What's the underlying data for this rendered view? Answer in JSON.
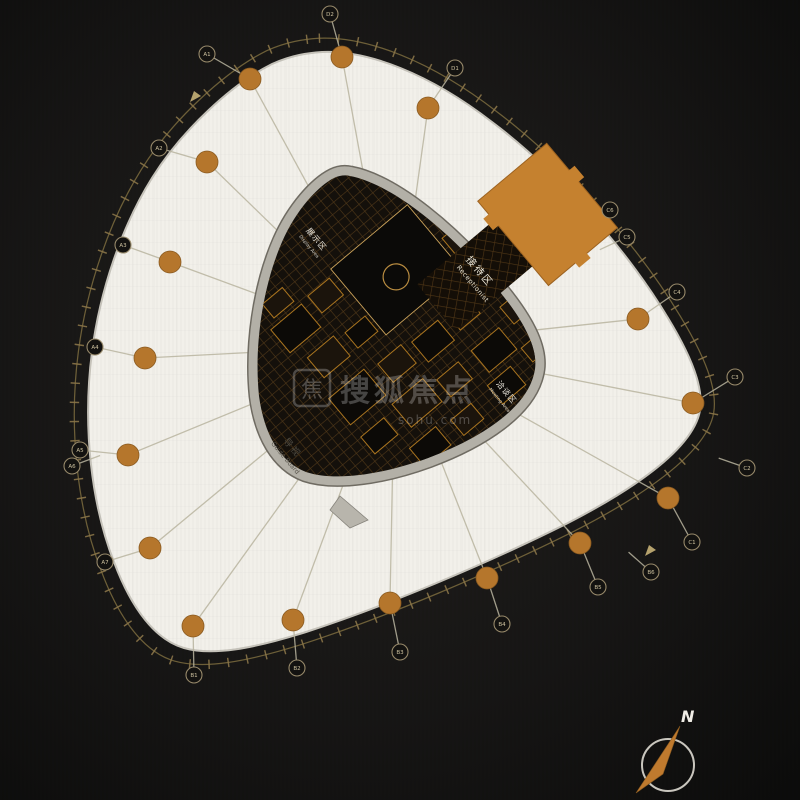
{
  "floor_plan": {
    "watermark": {
      "logo_char": "焦",
      "title": "搜狐焦点",
      "subtitle": "sohu.com"
    },
    "north": {
      "label": "N"
    },
    "zones": {
      "reception": {
        "zh": "接待区",
        "en": "Receptionist"
      },
      "guide_board": {
        "zh": "导视",
        "en": "Guide Board"
      },
      "area_left": {
        "zh": "展示区",
        "en": "Display Area"
      },
      "area_right": {
        "zh": "洽谈区",
        "en": "Meeting Area"
      }
    },
    "colors": {
      "background": "#121110",
      "slab": "#f2f0ea",
      "column": "#b5762c",
      "reception_block": "#c5812f",
      "core_ring": "#b3b0a7",
      "boundary": "#8a7448"
    },
    "grid": {
      "center": [
        395,
        345
      ],
      "dots": [
        [
          250,
          79
        ],
        [
          342,
          57
        ],
        [
          428,
          108
        ],
        [
          207,
          162
        ],
        [
          170,
          262
        ],
        [
          145,
          358
        ],
        [
          128,
          455
        ],
        [
          150,
          548
        ],
        [
          193,
          626
        ],
        [
          293,
          620
        ],
        [
          390,
          603
        ],
        [
          487,
          578
        ],
        [
          580,
          543
        ],
        [
          668,
          498
        ],
        [
          693,
          403
        ],
        [
          638,
          319
        ]
      ],
      "bubbles": [
        {
          "x": 207,
          "y": 54,
          "label": "A1",
          "from": [
            250,
            79
          ]
        },
        {
          "x": 330,
          "y": 14,
          "label": "D2",
          "from": [
            342,
            57
          ]
        },
        {
          "x": 455,
          "y": 68,
          "label": "D1",
          "from": [
            428,
            108
          ]
        },
        {
          "x": 159,
          "y": 148,
          "label": "A2",
          "from": [
            207,
            162
          ]
        },
        {
          "x": 123,
          "y": 245,
          "label": "A3",
          "from": [
            170,
            262
          ]
        },
        {
          "x": 95,
          "y": 347,
          "label": "A4",
          "from": [
            145,
            358
          ]
        },
        {
          "x": 80,
          "y": 450,
          "label": "A5",
          "from": [
            128,
            455
          ]
        },
        {
          "x": 72,
          "y": 466,
          "label": "A6",
          "from": null
        },
        {
          "x": 105,
          "y": 562,
          "label": "A7",
          "from": [
            150,
            548
          ]
        },
        {
          "x": 194,
          "y": 675,
          "label": "B1",
          "from": [
            193,
            626
          ]
        },
        {
          "x": 297,
          "y": 668,
          "label": "B2",
          "from": [
            293,
            620
          ]
        },
        {
          "x": 400,
          "y": 652,
          "label": "B3",
          "from": [
            390,
            603
          ]
        },
        {
          "x": 502,
          "y": 624,
          "label": "B4",
          "from": [
            487,
            578
          ]
        },
        {
          "x": 598,
          "y": 587,
          "label": "B5",
          "from": [
            580,
            543
          ]
        },
        {
          "x": 651,
          "y": 572,
          "label": "B6",
          "from": null
        },
        {
          "x": 692,
          "y": 542,
          "label": "C1",
          "from": [
            668,
            498
          ]
        },
        {
          "x": 747,
          "y": 468,
          "label": "C2",
          "from": null
        },
        {
          "x": 735,
          "y": 377,
          "label": "C3",
          "from": [
            693,
            403
          ]
        },
        {
          "x": 677,
          "y": 292,
          "label": "C4",
          "from": [
            638,
            319
          ]
        },
        {
          "x": 627,
          "y": 237,
          "label": "C5",
          "from": null
        },
        {
          "x": 610,
          "y": 210,
          "label": "C6",
          "from": null
        }
      ],
      "flags": [
        [
          190,
          102
        ],
        [
          645,
          556
        ]
      ]
    }
  }
}
